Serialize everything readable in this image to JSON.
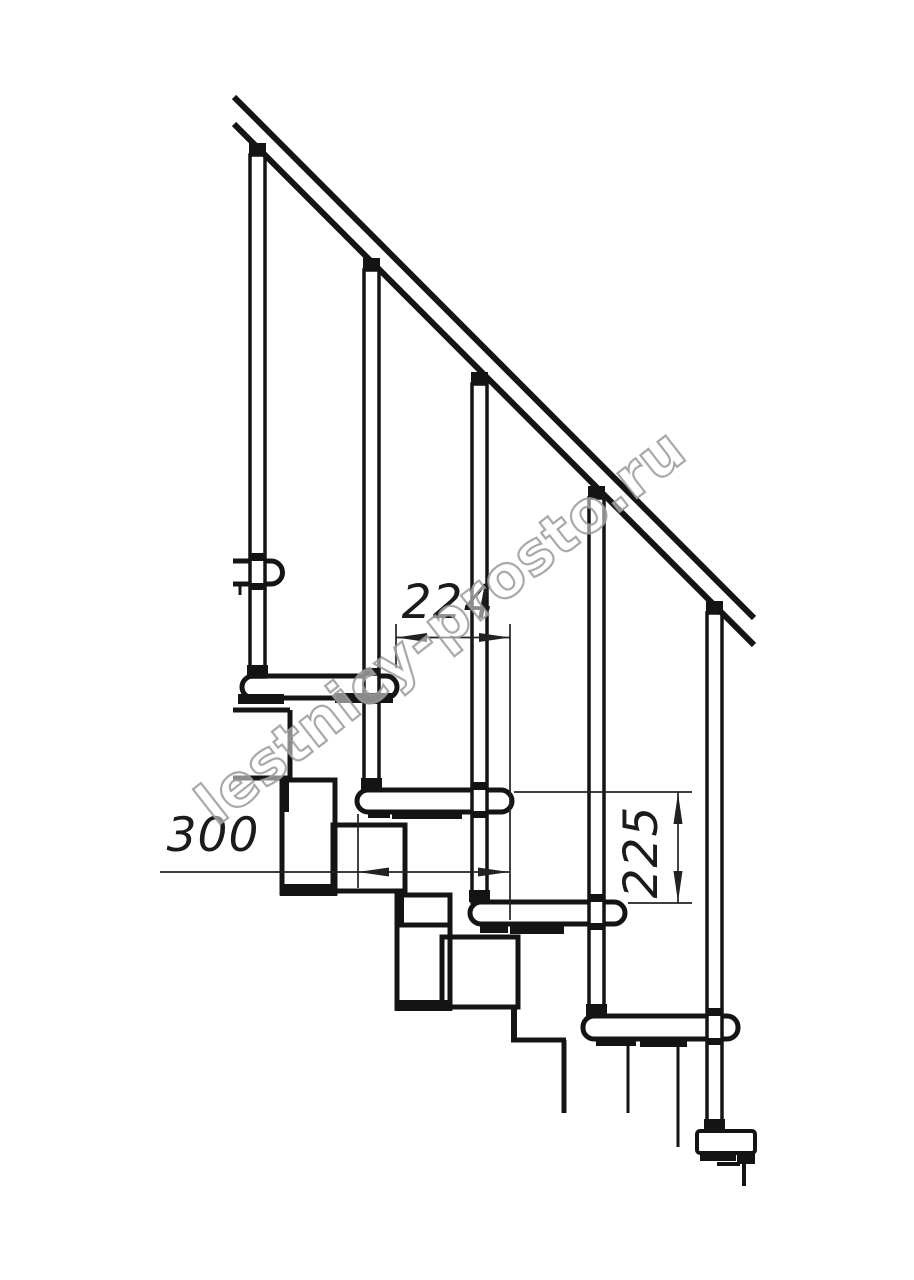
{
  "page": {
    "background": "#ffffff",
    "line_color": "#141414",
    "dimension_color": "#222222"
  },
  "drawing": {
    "dimensions": {
      "step_run": {
        "value": "224",
        "orientation": "horizontal"
      },
      "tread_depth": {
        "value": "300",
        "orientation": "horizontal"
      },
      "step_rise": {
        "value": "225",
        "orientation": "vertical"
      }
    },
    "watermark": {
      "text": "lestnicy-prosto.ru",
      "color": "#9a9a9a"
    }
  }
}
